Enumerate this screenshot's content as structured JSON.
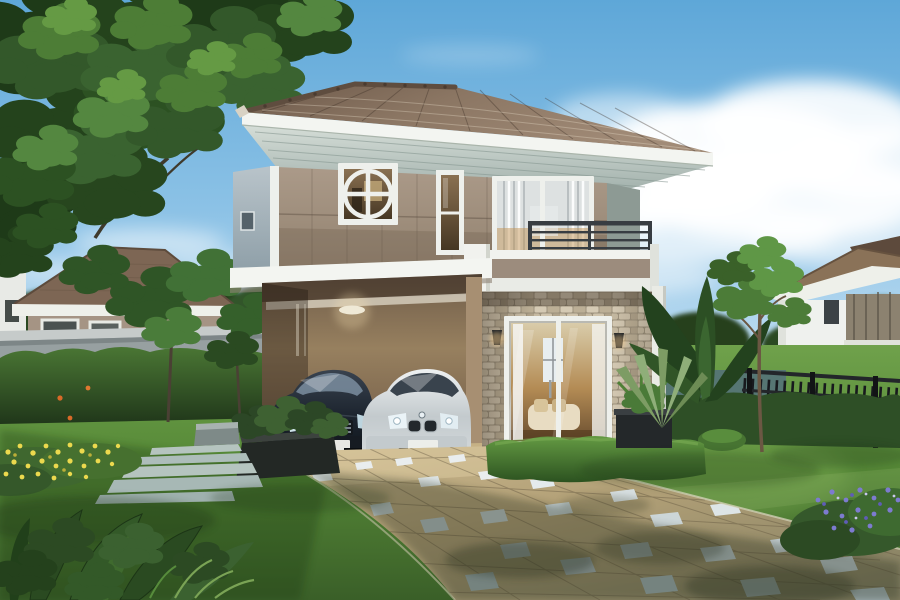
{
  "meta": {
    "title": "3D architectural rendering of a modern two-story suburban house with carport, two sedans, landscaped lawn and paved driveway",
    "type": "photorealistic-render",
    "text_content": "none - image contains no readable text"
  },
  "scene": {
    "sky": {
      "top": "#5ea7d8",
      "mid": "#9ccae9",
      "horizon": "#e3f1f9",
      "clouds": "#ffffff"
    },
    "main_house": {
      "roof_tile": "#97816d",
      "roof_shadow": "#6d594a",
      "ridge": "#5f4d3f",
      "fascia": "#f3f5f1",
      "soffit": "#c9d4ce",
      "upper_wall": "#a89786",
      "upper_wall_lower_band": "#93windows",
      "side_wall": "#b0bcc2",
      "corner_trim": "#edf0ec",
      "balcony_rail": "#383d42",
      "balcony_band": "#9c8c7d",
      "stone_cladding": "#c9bda6",
      "carport_interior": "#8a7459",
      "window_frame": "#eef0ec",
      "glass_warm": "#8a7152",
      "curtain": "#dde1e1"
    },
    "vehicles": [
      {
        "name": "dark-sedan",
        "body": "#161c26",
        "grille": "#9aa6ae",
        "plate": "#e8e8e4"
      },
      {
        "name": "silver-sedan",
        "body": "#d5dadd",
        "grille": "#23282c",
        "plate": "#eceeea"
      }
    ],
    "landscape": {
      "lawn_light": "#6fa14b",
      "lawn_dark": "#3a5f28",
      "hedge": "#2e4f26",
      "tree_canopy": "#33582a",
      "tree_highlight": "#659a44",
      "driveway_paver": "#c3b088",
      "driveway_shadow": "#7e7a5e",
      "accent_tile": "#e9edee",
      "stepping_stone": "#b5c4bf",
      "planter_box": "#262b28",
      "yellow_flowers": "#ecd94e",
      "purple_flowers": "#7d7bd0",
      "orange_flowers": "#d86a28",
      "boundary_wall": "#9aa2a3",
      "metal_fence": "#1b1e22"
    },
    "objects": [
      "large overhanging tree top-left",
      "main two-story house with hip roof",
      "circular feature window",
      "second-floor balcony with dark railing",
      "carport with two sedans",
      "stone-clad wall with sliding glass door",
      "two wall sconce lamps",
      "trimmed hedges",
      "stepping stone path",
      "yellow flower bed",
      "purple flower bush",
      "banana palm and fan palm",
      "tan paver driveway with white accent tiles",
      "neighbour house left",
      "neighbour house right",
      "black metal fence",
      "grey boundary wall"
    ]
  }
}
